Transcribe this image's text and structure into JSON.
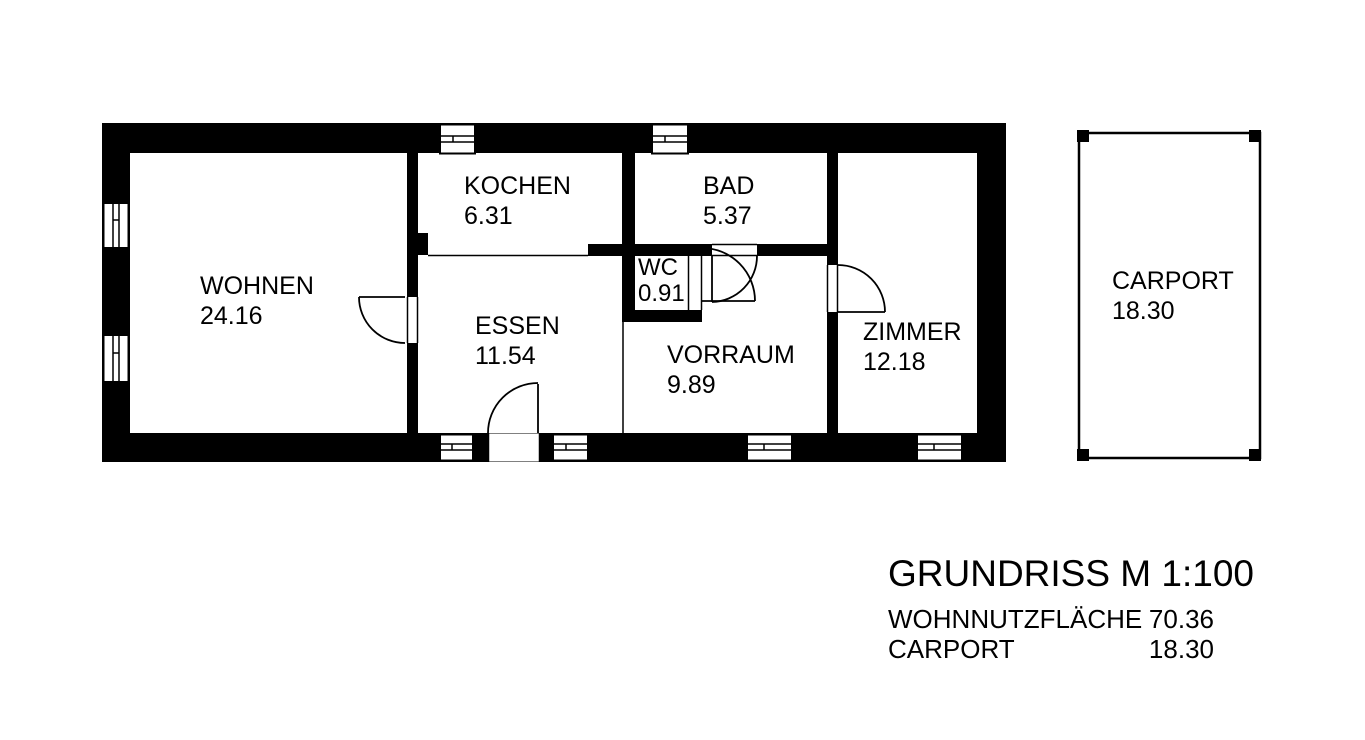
{
  "colors": {
    "wall": "#000000",
    "background": "#ffffff",
    "text": "#000000"
  },
  "rooms": {
    "wohnen": {
      "name": "WOHNEN",
      "area": "24.16"
    },
    "kochen": {
      "name": "KOCHEN",
      "area": "6.31"
    },
    "bad": {
      "name": "BAD",
      "area": "5.37"
    },
    "wc": {
      "name": "WC",
      "area": "0.91"
    },
    "essen": {
      "name": "ESSEN",
      "area": "11.54"
    },
    "vorraum": {
      "name": "VORRAUM",
      "area": "9.89"
    },
    "zimmer": {
      "name": "ZIMMER",
      "area": "12.18"
    },
    "carport": {
      "name": "CARPORT",
      "area": "18.30"
    }
  },
  "legend": {
    "title": "GRUNDRISS M 1:100",
    "rows": [
      {
        "label": "WOHNNUTZFLÄCHE",
        "value": "70.36"
      },
      {
        "label": "CARPORT",
        "value": "18.30"
      }
    ]
  }
}
